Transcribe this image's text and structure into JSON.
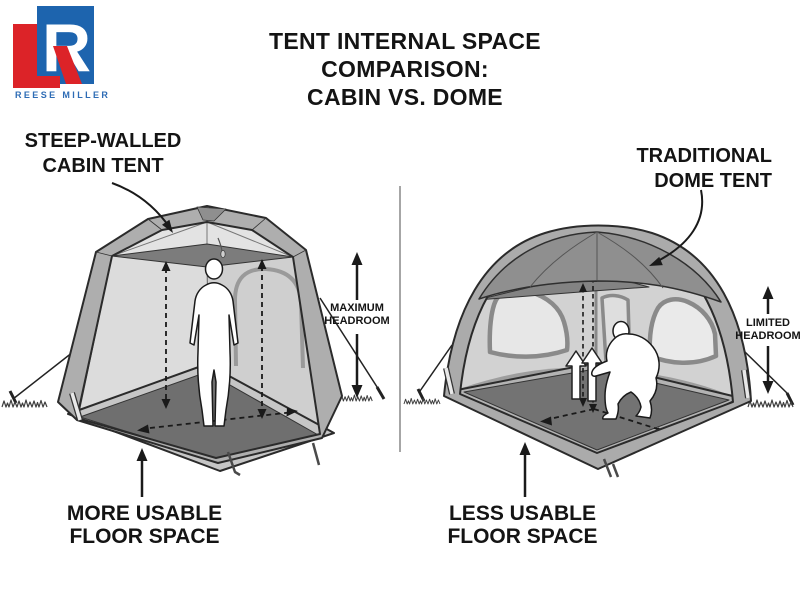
{
  "logo": {
    "brand": "REESE MILLER",
    "red": "#dc2328",
    "blue": "#1d64ae",
    "text_blue": "#2e6cb5"
  },
  "title": {
    "line1": "TENT INTERNAL SPACE",
    "line2": "COMPARISON:",
    "line3": "CABIN VS. DOME"
  },
  "cabin": {
    "label_line1": "STEEP-WALLED",
    "label_line2": "CABIN TENT",
    "headroom_line1": "MAXIMUM",
    "headroom_line2": "HEADROOM",
    "floor_line1": "MORE USABLE",
    "floor_line2": "FLOOR SPACE"
  },
  "dome": {
    "label_line1": "TRADITIONAL",
    "label_line2": "DOME TENT",
    "headroom_line1": "LIMITED",
    "headroom_line2": "HEADROOM",
    "floor_line1": "LESS USABLE",
    "floor_line2": "FLOOR SPACE"
  },
  "palette": {
    "ink": "#2b2b2b",
    "tent_shell": "#aeaeae",
    "tent_ceiling": "#7c7c7c",
    "tent_wall_light": "#dcdcdc",
    "tent_floor_dark": "#6f6f6f",
    "divider_gray": "#a6a6a6"
  }
}
